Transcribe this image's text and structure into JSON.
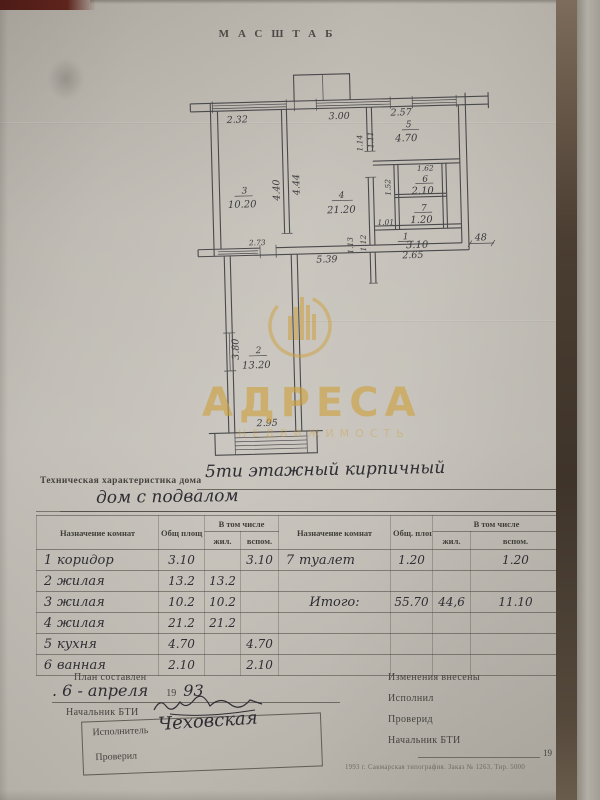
{
  "page": {
    "heading": "МАСШТАБ"
  },
  "watermark": {
    "brand": "АДРЕСА",
    "tagline": "НЕДВИЖИМОСТЬ",
    "color": "#cd9f3c"
  },
  "plan": {
    "dims": {
      "top_left": "2.32",
      "top_mid": "3.00",
      "top_right": "2.57",
      "room3_v1": "4.40",
      "room3_v2": "4.44",
      "hall_v1": "1.14",
      "hall_v2": "1.11",
      "hall_v3": "1.52",
      "hall_v4": "1.13",
      "hall_v5": "1.12",
      "bath_w": "1.62",
      "wc_w": "1.01",
      "hall_bottom": "2.65",
      "wall_thickness": "48",
      "bottom": "5.39",
      "room3_bottom": "2.73",
      "room2_v": "3.80",
      "room2_bottom": "2.95"
    },
    "rooms": {
      "hall": {
        "num": "1",
        "area": "3.10"
      },
      "room2": {
        "num": "2",
        "area": "13.20"
      },
      "room3": {
        "num": "3",
        "area": "10.20"
      },
      "room4": {
        "num": "4",
        "area": "21.20"
      },
      "kitchen": {
        "num": "5",
        "area": "4.70"
      },
      "bath": {
        "num": "6",
        "area": "2.10"
      },
      "wc": {
        "num": "7",
        "area": "1.20"
      }
    }
  },
  "title": {
    "printed": "Техническая характеристика дома",
    "handwritten_1": "5ти этажный кирпичный",
    "handwritten_2": "дом с подвалом"
  },
  "table": {
    "header": {
      "name_l": "Назначение комнат",
      "total_l": "Общ площ",
      "incl_l": "В том числе",
      "living_l": "жил.",
      "aux_l": "вспом.",
      "name_r": "Назначение комнат",
      "total_r": "Общ. площ.",
      "incl_r": "В том числе",
      "living_r": "жил.",
      "aux_r": "вспом."
    },
    "rows": [
      {
        "num": "1",
        "name": "коридор",
        "total": "3.10",
        "living": "",
        "aux": "3.10",
        "rnum": "7",
        "rname": "туалет",
        "rtotal": "1.20",
        "rliving": "",
        "raux": "1.20"
      },
      {
        "num": "2",
        "name": "жилая",
        "total": "13.2",
        "living": "13.2",
        "aux": "",
        "rnum": "",
        "rname": "",
        "rtotal": "",
        "rliving": "",
        "raux": ""
      },
      {
        "num": "3",
        "name": "жилая",
        "total": "10.2",
        "living": "10.2",
        "aux": "",
        "rnum": "",
        "rname": "Итого:",
        "rtotal": "55.70",
        "rliving": "44,6",
        "raux": "11.10"
      },
      {
        "num": "4",
        "name": "жилая",
        "total": "21.2",
        "living": "21.2",
        "aux": "",
        "rnum": "",
        "rname": "",
        "rtotal": "",
        "rliving": "",
        "raux": ""
      },
      {
        "num": "5",
        "name": "кухня",
        "total": "4.70",
        "living": "",
        "aux": "4.70",
        "rnum": "",
        "rname": "",
        "rtotal": "",
        "rliving": "",
        "raux": ""
      },
      {
        "num": "6",
        "name": "ванная",
        "total": "2.10",
        "living": "",
        "aux": "2.10",
        "rnum": "",
        "rname": "",
        "rtotal": "",
        "rliving": "",
        "raux": ""
      }
    ]
  },
  "footer": {
    "plan_made_label": "План составлен",
    "date_hw": ". 6 - апреля",
    "year_printed": "19",
    "year_hw": "93",
    "chief_bti_label": "Начальник БТИ",
    "executor_label": "Исполнитель",
    "executor_name_hw": "Чеховская",
    "checked_label": "Проверил",
    "changes_label": "Изменения  внесены",
    "done_label": "Исполнил",
    "checked_label_r": "Проверид",
    "chief_bti_label_r": "Начальник БТИ",
    "date_year_r": "19",
    "date_g_r": "г.",
    "print_line": "1993 г.  Сакмарская типография.  Заказ № 1263.  Тир. 5000"
  }
}
